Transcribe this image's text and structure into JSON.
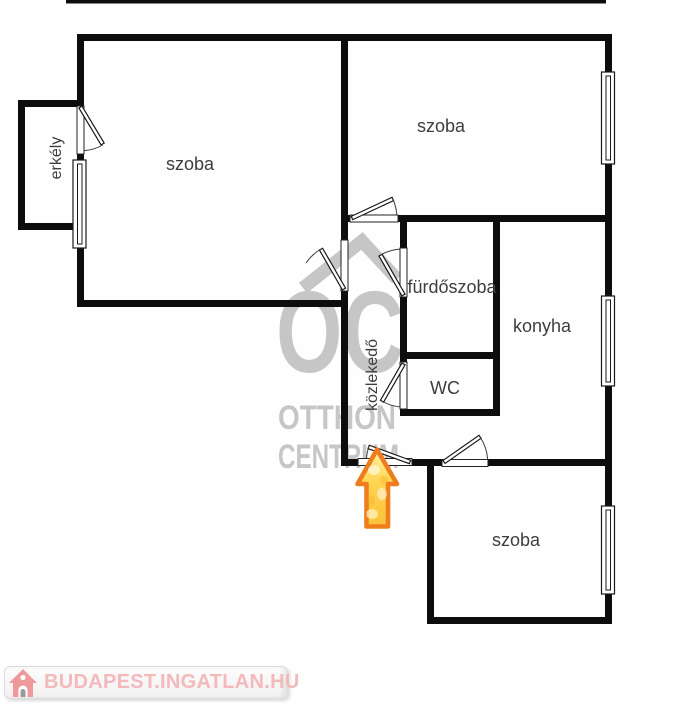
{
  "floorplan": {
    "rooms": {
      "room_top_left": {
        "label": "szoba"
      },
      "room_top_right": {
        "label": "szoba"
      },
      "room_bottom": {
        "label": "szoba"
      },
      "bathroom": {
        "label": "fürdőszoba"
      },
      "kitchen": {
        "label": "konyha"
      },
      "wc": {
        "label": "WC"
      },
      "hallway": {
        "label": "közlekedő"
      },
      "balcony": {
        "label": "erkély"
      }
    },
    "symbols": {
      "entrance_arrow_icon": "up-arrow",
      "door_icon": "door-swing-quarter-arc",
      "window_icon": "double-line-window"
    },
    "watermark": {
      "monogram": "OC",
      "line1": "OTTHON",
      "line2": "CENTRUM",
      "roof_icon": "roof-chevron"
    }
  },
  "footer": {
    "brand": "BUDAPEST.INGATLAN.HU",
    "house_icon": "house"
  },
  "colors": {
    "wall": "#0d0d0d",
    "room_label": "#3e3e3e",
    "watermark_gray": "#c6c6c6",
    "arrow_outline": "#ee7e1d",
    "arrow_fill": "#ffd34d",
    "footer_text_pink": "#f4b9bb",
    "footer_icon_pink": "#ee9a9d"
  }
}
